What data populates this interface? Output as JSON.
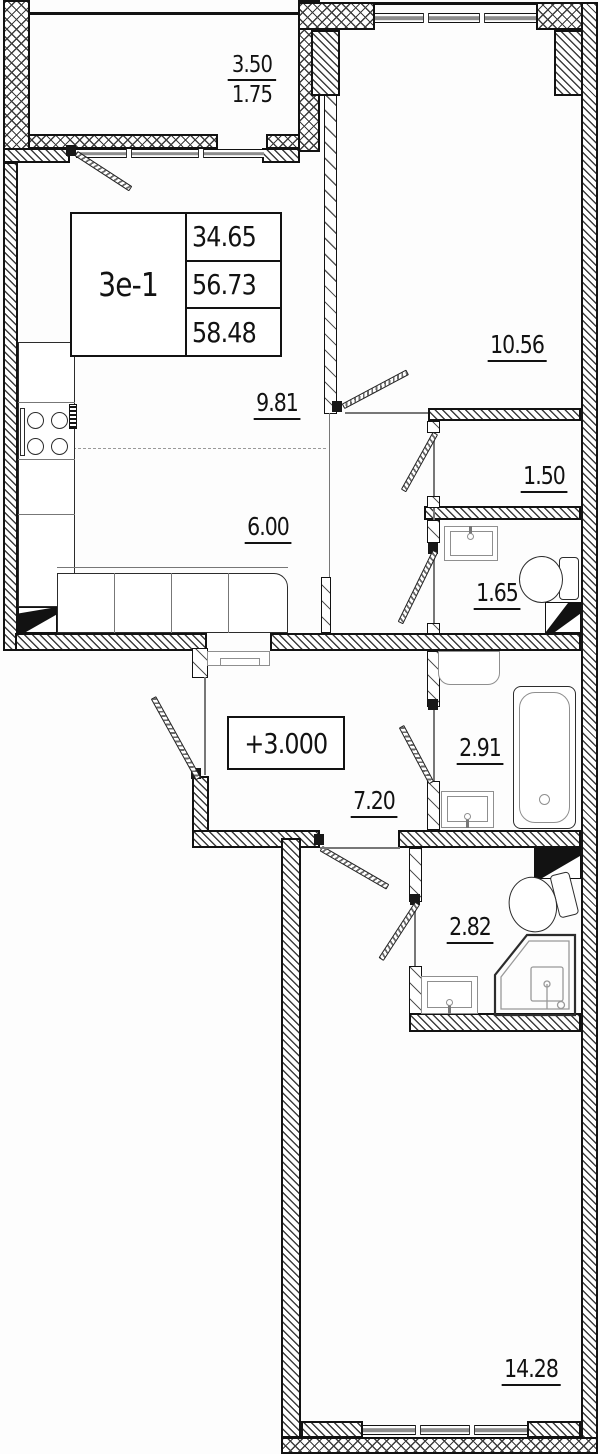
{
  "unit": {
    "label": "3е-1",
    "areas": [
      "34.65",
      "56.73",
      "58.48"
    ]
  },
  "elevation_mark": "+3.000",
  "rooms": {
    "balcony": {
      "full": "3.50",
      "counted": "1.75"
    },
    "room_top": "10.56",
    "kitchen": "9.81",
    "living": "6.00",
    "wardrobe": "1.50",
    "wc": "1.65",
    "hall": "7.20",
    "bathroom": "2.91",
    "shower_room": "2.82",
    "room_bottom": "14.28"
  },
  "icons": {
    "stove": "four-burner-circles",
    "sink": "rect-basin-with-faucet",
    "toilet": "bowl-with-tank",
    "bathtub": "rounded-rect-with-drain",
    "shower": "corner-tray",
    "duct": "shaft-black-diagonal",
    "door": "hatched-leaf-swing",
    "window": "double-line-gray-bar"
  },
  "colors": {
    "line": "#121212",
    "glass": "#8d8d8d",
    "background": "#fdfdfd"
  }
}
